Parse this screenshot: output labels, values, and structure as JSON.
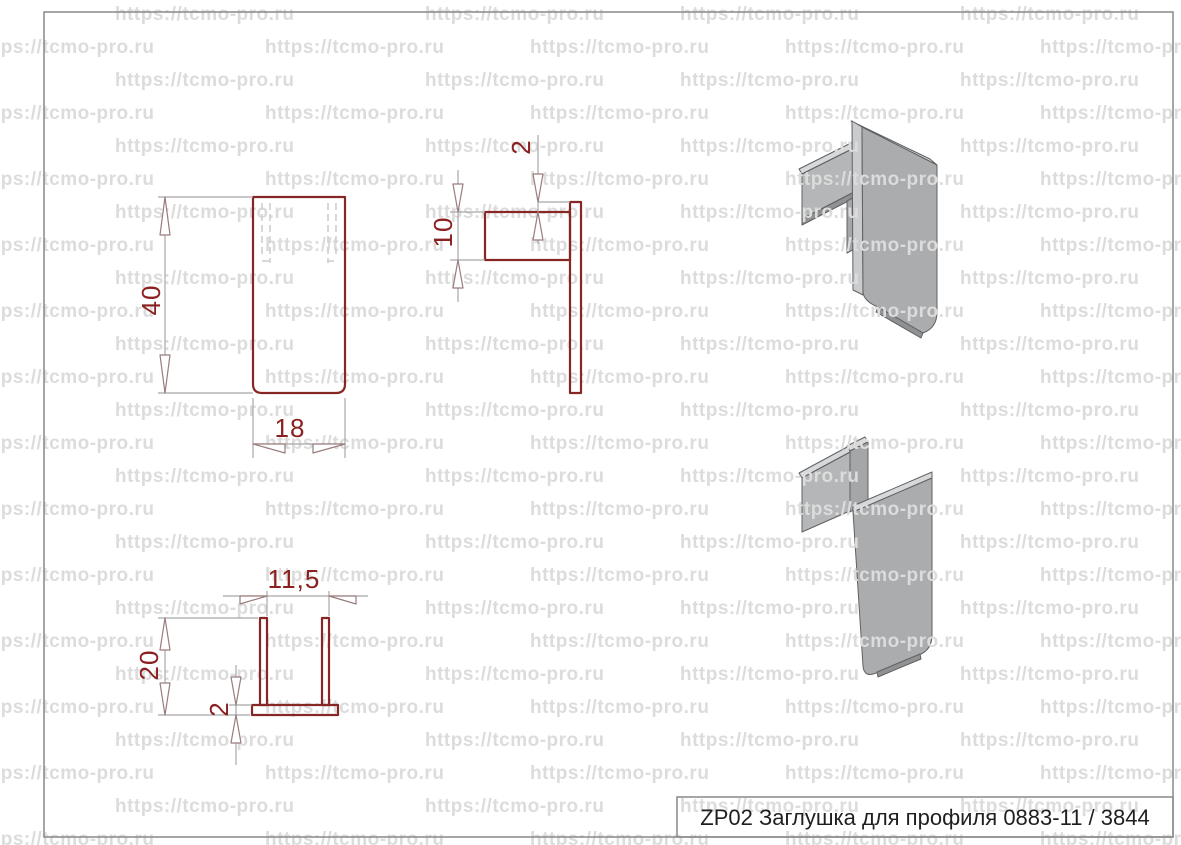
{
  "watermark": {
    "text": "https://tcmo-pro.ru"
  },
  "title_block": {
    "label": "ZP02 Заглушка для профиля 0883-11  / 3844"
  },
  "dimensions": {
    "front_height": "40",
    "front_width": "18",
    "side_offset": "2",
    "side_tab_height": "10",
    "bottom_leg_spacing": "11,5",
    "bottom_leg_depth": "20",
    "bottom_plate_thickness": "2"
  },
  "colors": {
    "outline-red": "#872725",
    "dim-text-red": "#8b2020",
    "dim-line-gray": "#a8a8a8",
    "arrow-stroke": "#9a7d7d",
    "hidden-line-gray": "#cfcfcf",
    "frame-gray": "#8f8f8f",
    "iso-stroke": "#5f6163",
    "part-gray": "#aaacae",
    "part-gray-mid2": "#b4b6b8",
    "part-gray-middark": "#a4a6a8",
    "part-gray-edge": "#c9cbcd",
    "part-gray-light": "#d6d8da",
    "part-gray-dark": "#8f9193",
    "watermark-gray": "#dcdcdc",
    "title-text": "#1f1f1f"
  }
}
